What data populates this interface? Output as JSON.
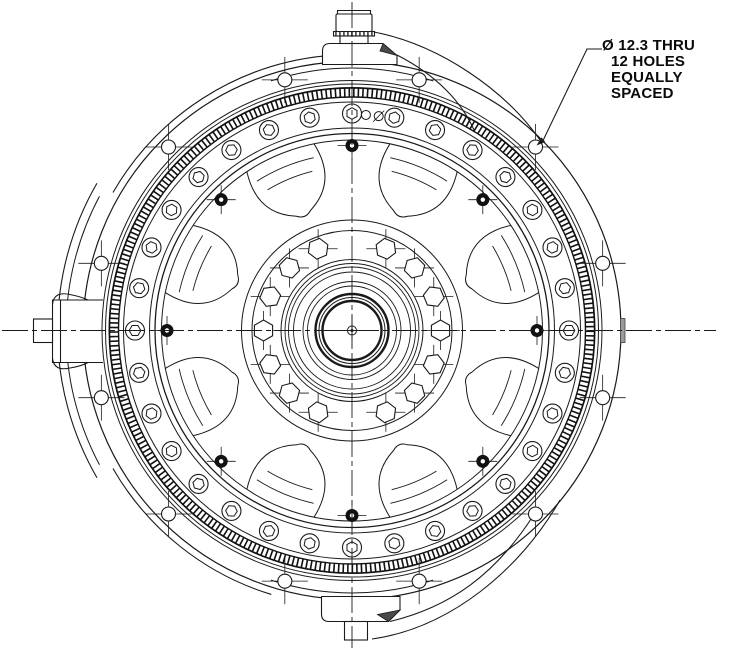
{
  "annotation": {
    "lines": [
      "Ø 12.3 THRU",
      "12 HOLES",
      "EQUALLY",
      "SPACED"
    ]
  },
  "drawing": {
    "colors": {
      "line": "#1a1a1a",
      "background": "#ffffff",
      "dark_fill": "#4a4a4a",
      "face_tick": "#9a9a9a"
    },
    "center": {
      "x": 352,
      "y": 330.5
    },
    "circles": [
      {
        "r": 269,
        "w": 1.2
      },
      {
        "r": 250,
        "w": 1
      },
      {
        "r": 246.5,
        "w": 1
      },
      {
        "r": 243,
        "w": 1
      },
      {
        "r": 228.5,
        "w": 1
      },
      {
        "r": 202.5,
        "w": 1
      },
      {
        "r": 197,
        "w": 1.3
      },
      {
        "r": 190.5,
        "w": 1
      },
      {
        "r": 110.5,
        "w": 1
      },
      {
        "r": 100,
        "w": 1
      },
      {
        "r": 71,
        "w": 1
      },
      {
        "r": 67,
        "w": 0.9
      },
      {
        "r": 63.5,
        "w": 0.9
      },
      {
        "r": 58.5,
        "w": 0.9
      },
      {
        "r": 49,
        "w": 0.9
      },
      {
        "r": 44.5,
        "w": 0.9
      },
      {
        "r": 36.5,
        "w": 2.4
      },
      {
        "r": 33,
        "w": 1
      },
      {
        "r": 29.5,
        "w": 2.4
      }
    ],
    "spline_band": {
      "r_outer": 242.5,
      "r_inner": 233.5,
      "edge_width": 1.4,
      "hatch_radius": 238,
      "hatch_width": 8.6,
      "hatch_dash": [
        1.6,
        3.0
      ]
    },
    "extra_arcs": [
      {
        "r": 294.5,
        "a1": 150,
        "a2": 210,
        "w": 1.1
      },
      {
        "r": 286,
        "a1": 152,
        "a2": 208,
        "w": 1
      },
      {
        "r": 276,
        "a1": 95.5,
        "a2": 150,
        "w": 1.1
      },
      {
        "r": 276,
        "a1": 210,
        "a2": 253,
        "w": 1.1
      },
      {
        "r": 262.5,
        "a1": 72,
        "a2": 108,
        "w": 1
      },
      {
        "r": 262.5,
        "a1": 252,
        "a2": 288,
        "w": 1
      }
    ],
    "bolt_holes": {
      "count": 12,
      "bolt_circle_radius": 259.5,
      "hole_radius": 7,
      "start_angle_deg": 15,
      "step_deg": 30,
      "tick_len": 16
    },
    "ring_holes": {
      "count": 32,
      "radius": 217,
      "outer_radius": 9.5,
      "hex_radius": 5.8,
      "start_angle_deg": 0,
      "step_deg": 11.25
    },
    "hub_bolts": {
      "radius": 88.5,
      "hex_radius": 10.5,
      "tick_len": 9,
      "angles_deg": [
        0,
        22.5,
        45,
        67.5,
        112.5,
        135,
        157.5,
        180,
        202.5,
        225,
        247.5,
        292.5,
        315,
        337.5
      ]
    },
    "spoke_holes": {
      "count": 8,
      "radius": 185,
      "outer_radius": 6.5,
      "inner_radius": 2.2,
      "start_angle_deg": 0,
      "step_deg": 45,
      "tick_len": 8
    },
    "windows": {
      "count": 8,
      "bisector_start_deg": 22.5,
      "step_deg": 45,
      "rim_radius": 190.5,
      "inner_radius": 120.5,
      "half_angle_deg": 11,
      "arc_radii": [
        164,
        177
      ],
      "arc_half_angles_deg": [
        8.5,
        10
      ]
    },
    "vent_holes": {
      "radius": 216,
      "hole_radius": 4.5,
      "angles_deg": [
        86.3,
        82.9
      ]
    },
    "center_mark": {
      "r1": 4.5,
      "r2": 1.5,
      "tick": 15
    },
    "centerlines": {
      "dash": [
        26,
        4,
        5,
        4
      ],
      "h_x1": 2,
      "h_x2": 716,
      "v_y1": 2,
      "v_y2": 648
    }
  }
}
